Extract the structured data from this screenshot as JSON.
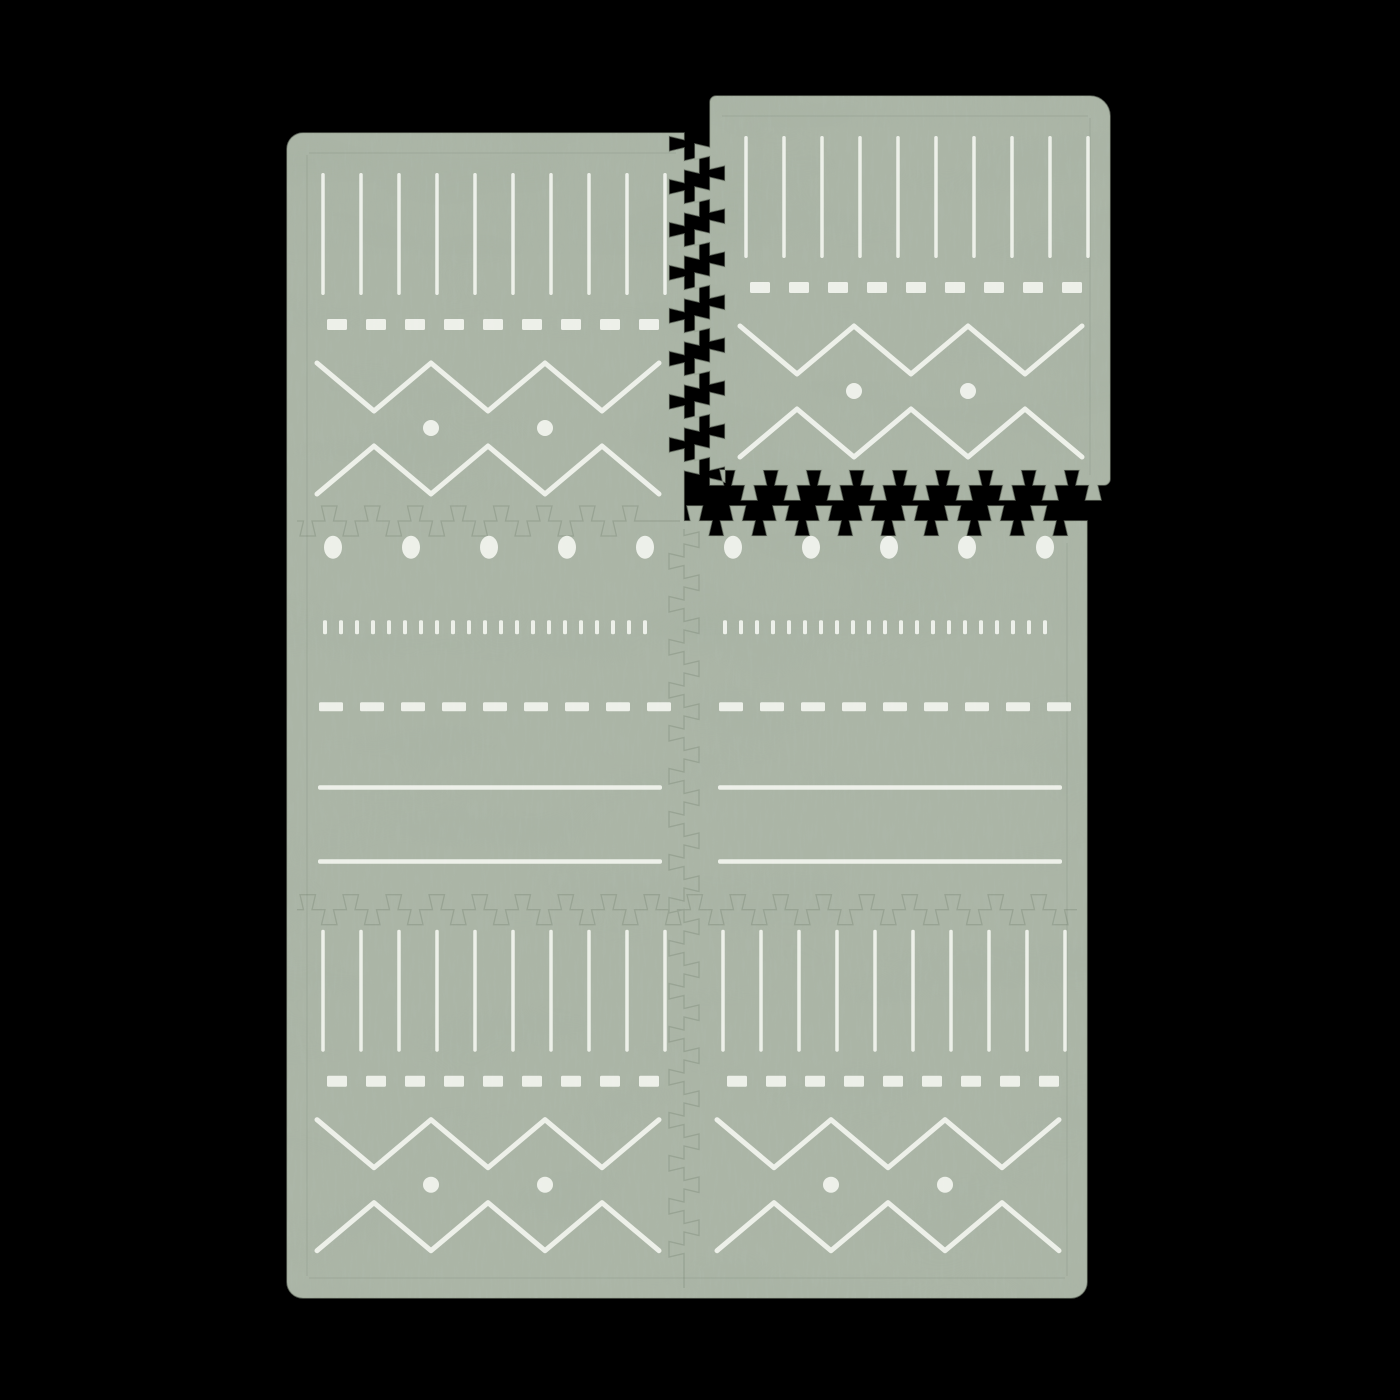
{
  "scene": {
    "description": "Sage green interlocking foam baby play mat, 2 by 3 puzzle tiles with white boho mudcloth pattern, top-right tile detached showing dovetail interlock edges, on black background",
    "canvas": {
      "width": 1400,
      "height": 1400,
      "background": "#000000"
    },
    "colors": {
      "mat_base": "#abb5a6",
      "streak_dark": "#6b7a68",
      "blotch_dark": "#5a6a58",
      "edge_stroke": "#95a18f",
      "seam_stroke": "#4f5e4c",
      "pattern_white": "#f3f5ef"
    },
    "mat": {
      "x": 287,
      "y": 133,
      "width": 800,
      "height": 1165,
      "cols": 2,
      "rows": 3,
      "corner_radius": 16,
      "seam_x": 684,
      "seam_y1": 521,
      "seam_y2": 909.7,
      "missing_tile": {
        "col": 1,
        "row": 0
      }
    },
    "detached_tile": {
      "x": 710,
      "y": 96,
      "width": 400,
      "height": 389,
      "corner_radius_outer": 20,
      "corner_radius_small": 6
    },
    "tooth": {
      "period": 43,
      "depth": 15,
      "tip_inset": 3,
      "tip_far": 18.5,
      "neck_near": 6.5,
      "neck_far": 15
    },
    "tile_patterns": {
      "zigzag": {
        "vlines": {
          "y1": 40,
          "y2": 162,
          "width": 3.5,
          "start_x": 36,
          "step": 38,
          "count": 10
        },
        "dash_row": {
          "y": 186,
          "height": 11,
          "start_x": 40,
          "dash": 20,
          "period": 39,
          "count": 9
        },
        "zig_upper": {
          "x_start": 30,
          "x_end": 372,
          "half_period": 57,
          "y_top": 230,
          "y_bottom": 278,
          "stroke": 5,
          "start_at": "top"
        },
        "zig_lower": {
          "x_start": 30,
          "x_end": 372,
          "half_period": 57,
          "y_top": 313,
          "y_bottom": 361,
          "stroke": 5,
          "start_at": "bottom"
        },
        "dots": {
          "cy": 295,
          "r": 8,
          "cxs": [
            144,
            258
          ]
        }
      },
      "lines": {
        "big_dots": {
          "cy": 26,
          "rx": 9,
          "ry": 11.5,
          "start_x": 46,
          "step": 78,
          "count": 5
        },
        "tick_row": {
          "y1": 99,
          "y2": 113,
          "width": 4,
          "start_x": 38,
          "step": 16,
          "count": 21
        },
        "dash_row": {
          "y": 181,
          "height": 9,
          "start_x": 32,
          "dash": 24,
          "period": 41,
          "count": 9
        },
        "line1": {
          "y": 264,
          "height": 4.5,
          "x1": 31,
          "x2": 375
        },
        "line2": {
          "y": 338,
          "height": 4.5,
          "x1": 31,
          "x2": 375
        }
      }
    },
    "placements": [
      {
        "pattern": "zigzag",
        "x": 287,
        "y": 133,
        "dy": 0,
        "part": "mat-tile-row1-left"
      },
      {
        "pattern": "lines",
        "x": 287,
        "y": 521.3,
        "dy": 0,
        "part": "mat-tile-row2-left"
      },
      {
        "pattern": "lines",
        "x": 687,
        "y": 521.3,
        "dy": 0,
        "part": "mat-tile-row2-right"
      },
      {
        "pattern": "zigzag",
        "x": 287,
        "y": 909.7,
        "dy": -20,
        "part": "mat-tile-row3-left"
      },
      {
        "pattern": "zigzag",
        "x": 687,
        "y": 909.7,
        "dy": -20,
        "part": "mat-tile-row3-right"
      },
      {
        "pattern": "zigzag",
        "x": 710,
        "y": 96,
        "dy": 0,
        "part": "detached-tile"
      }
    ],
    "texture": {
      "streak_base_frequency": "0.32 0.045",
      "streak_octaves": 3,
      "streak_seed": 8,
      "streak_opacity": 0.6,
      "blotch_base_frequency": "0.006 0.015",
      "blotch_octaves": 2,
      "blotch_seed": 3,
      "blotch_opacity": 0.22
    },
    "pattern_opacity": 0.93,
    "seam_opacity": 0.2,
    "border_seam_opacity": 0.09
  }
}
